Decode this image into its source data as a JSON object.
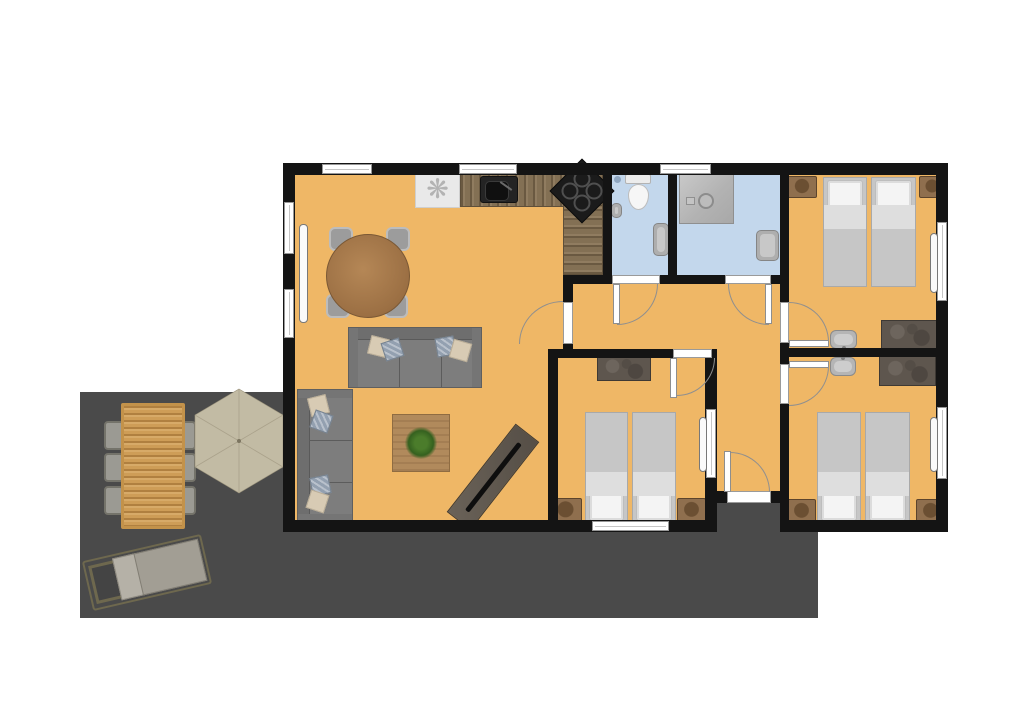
{
  "meta": {
    "type": "apartment-floor-plan",
    "canvas": {
      "width": 1024,
      "height": 726
    },
    "visible_text": "none"
  },
  "palette": {
    "floor": "#efb766",
    "bathroom": "#c3d7ec",
    "terrace": "#4a4a4a",
    "wall": "#141414",
    "bedBlanket": "#c6c6c6",
    "bedSheet": "#dedede",
    "pillow": "#f4f4f4",
    "sofa": "#7d7d7d",
    "pillowBeige": "#d8cbb4",
    "pillowBlue": "#93a0b0",
    "umbrella": "#c2bba4",
    "umbrellaLine": "#aaa28b",
    "arcline": "#8f8f8f"
  },
  "icons": {
    "fan_glyph": "❋"
  },
  "rooms": [
    {
      "id": "living-room-kitchen",
      "floor": "orange",
      "furniture": [
        "round-dining-table",
        "4-chairs",
        "sofa-horizontal",
        "sofa-vertical",
        "coffee-table-with-plant",
        "tv-sideboard-diagonal",
        "kitchen-counter-L",
        "kitchen-sink",
        "cooktop",
        "fan-unit"
      ]
    },
    {
      "id": "bathroom-1",
      "floor": "blue",
      "furniture": [
        "toilet",
        "hand-basin",
        "washbasin"
      ]
    },
    {
      "id": "bathroom-2",
      "floor": "blue",
      "furniture": [
        "shower",
        "washbasin"
      ]
    },
    {
      "id": "bedroom-1",
      "floor": "orange",
      "furniture": [
        "twin-bed",
        "twin-bed",
        "nightstand",
        "nightstand",
        "sink",
        "dresser"
      ]
    },
    {
      "id": "hallway",
      "floor": "orange",
      "furniture": []
    },
    {
      "id": "bedroom-2",
      "floor": "orange",
      "furniture": [
        "twin-bed",
        "twin-bed",
        "nightstand",
        "nightstand",
        "dresser"
      ]
    },
    {
      "id": "bedroom-3",
      "floor": "orange",
      "furniture": [
        "twin-bed",
        "twin-bed",
        "nightstand",
        "nightstand",
        "sink",
        "dresser"
      ]
    },
    {
      "id": "entrance-corridor",
      "floor": "orange",
      "furniture": []
    },
    {
      "id": "terrace",
      "floor": "dark-gray",
      "furniture": [
        "outdoor-dining-table",
        "6-outdoor-chairs",
        "parasol-hexagonal",
        "sun-lounger"
      ]
    }
  ],
  "openings": {
    "windows": 9,
    "interior_doors": 6,
    "entrance_doors": 1
  }
}
